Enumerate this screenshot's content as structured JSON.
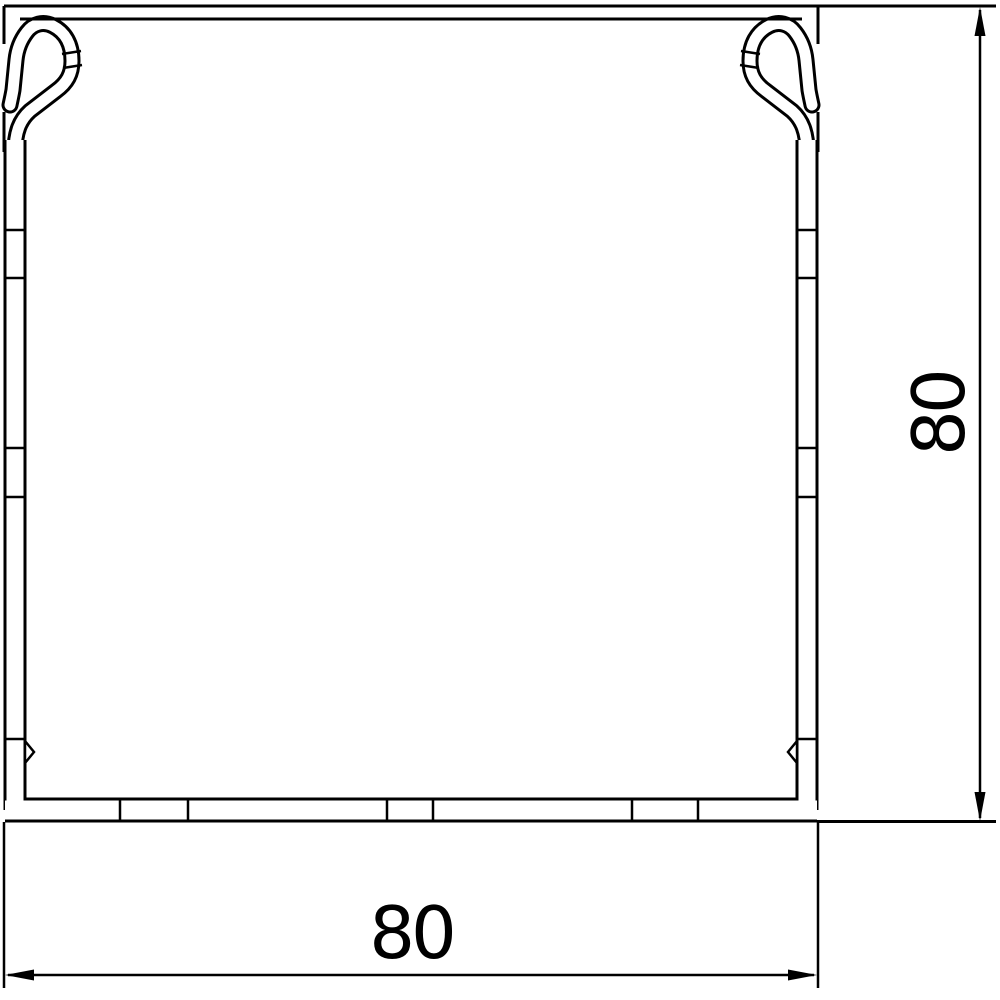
{
  "drawing": {
    "type": "technical-cross-section",
    "subject": "square cable trunking profile with snap-in cover clips",
    "background_color": "#ffffff",
    "line_color": "#000000"
  },
  "dimensions": {
    "width": {
      "label": "80",
      "orientation": "horizontal",
      "position": "bottom"
    },
    "height": {
      "label": "80",
      "orientation": "vertical",
      "position": "right"
    }
  }
}
